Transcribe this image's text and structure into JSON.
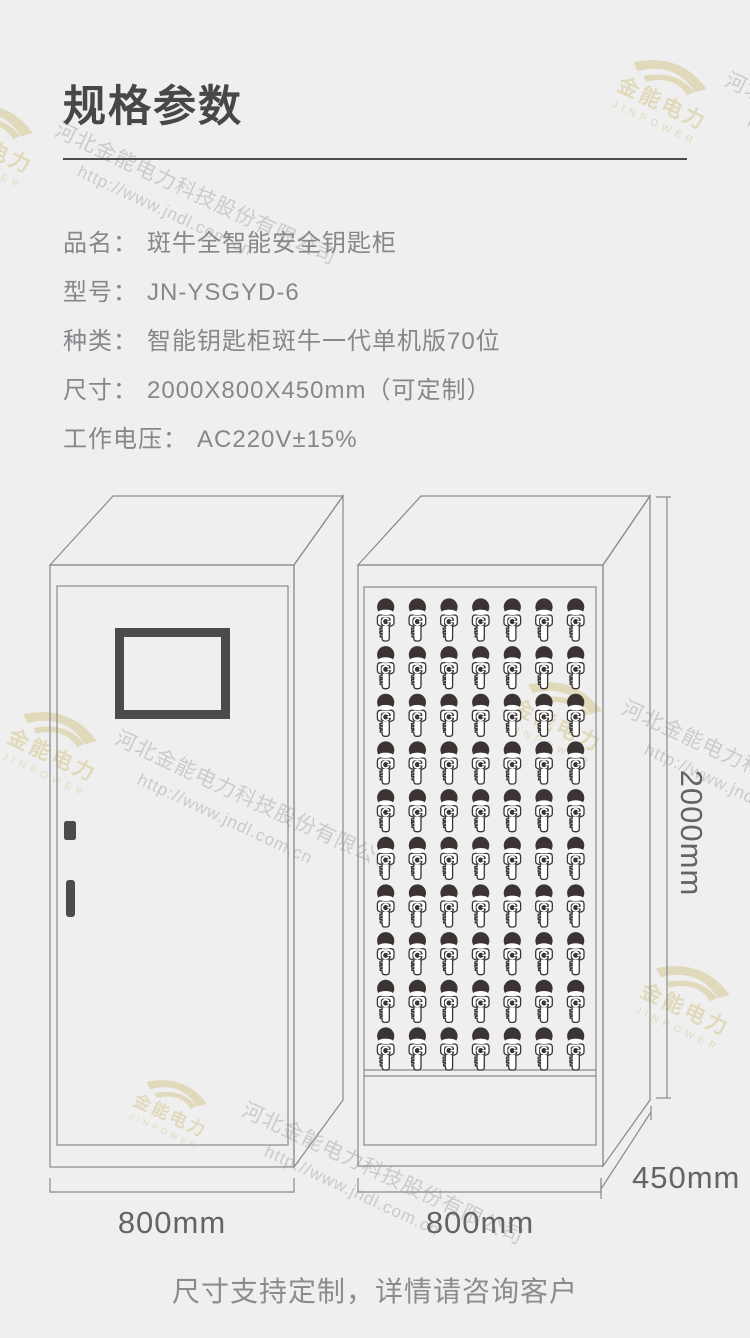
{
  "header": {
    "title": "规格参数"
  },
  "specs": [
    {
      "label": "品名：",
      "value": "斑牛全智能安全钥匙柜"
    },
    {
      "label": "型号：",
      "value": "JN-YSGYD-6"
    },
    {
      "label": "种类：",
      "value": "智能钥匙柜斑牛一代单机版70位"
    },
    {
      "label": "尺寸：",
      "value": "2000X800X450mm（可定制）"
    },
    {
      "label": "工作电压：",
      "value": "AC220V±15%"
    }
  ],
  "diagram": {
    "left_cabinet": {
      "description": "closed cabinet with display screen",
      "width_label": "800mm"
    },
    "right_cabinet": {
      "description": "open cabinet with key hooks",
      "width_label": "800mm",
      "key_grid": {
        "rows": 10,
        "columns": 7,
        "total_keys": 70
      }
    },
    "height_label": "2000mm",
    "depth_label": "450mm"
  },
  "footer": {
    "note": "尺寸支持定制，详情请咨询客户"
  },
  "watermark": {
    "company": "河北金能电力科技股份有限公司",
    "url": "http://www.jndl.com.cn",
    "logo_cn": "金能电力",
    "logo_en": "JINPOWER"
  },
  "colors": {
    "background": "#efeff0",
    "line": "#8a8a8a",
    "dark": "#4b4b4b",
    "key": "#3a3432",
    "gold": "#d8cc9b",
    "watermark_text": "#97979b",
    "text": "#87878b",
    "title": "#474747",
    "dimension": "#646464"
  }
}
